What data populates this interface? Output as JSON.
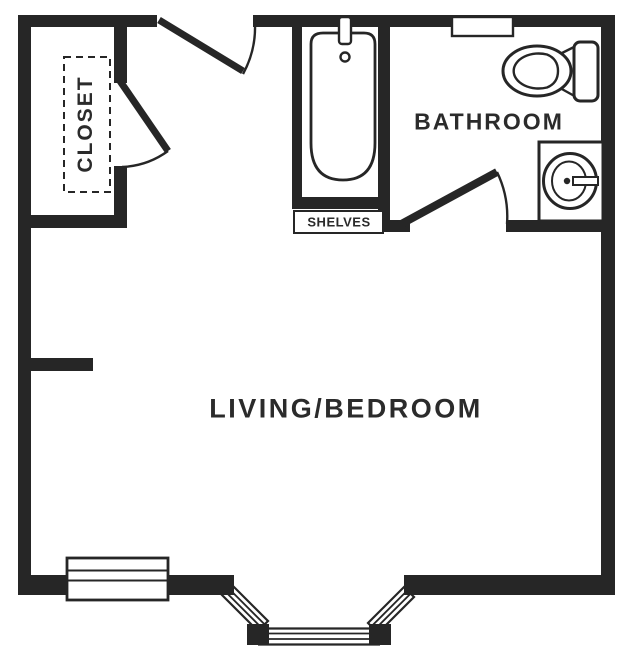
{
  "floorplan": {
    "type": "studio-apartment-floor-plan",
    "colors": {
      "ink": "#262626",
      "background": "#ffffff",
      "label_text": "#2b2b2b"
    },
    "rooms": {
      "living": {
        "label": "LIVING/BEDROOM"
      },
      "bathroom": {
        "label": "BATHROOM"
      },
      "closet": {
        "label": "CLOSET"
      },
      "shelves": {
        "label": "SHELVES"
      }
    },
    "fixtures": [
      "bathtub",
      "tub-faucet",
      "tub-drain",
      "toilet",
      "toilet-tank",
      "sink-vanity",
      "medicine-cabinet",
      "entry-door",
      "closet-door",
      "bathroom-door",
      "left-window",
      "bay-window",
      "wall-stub"
    ]
  }
}
